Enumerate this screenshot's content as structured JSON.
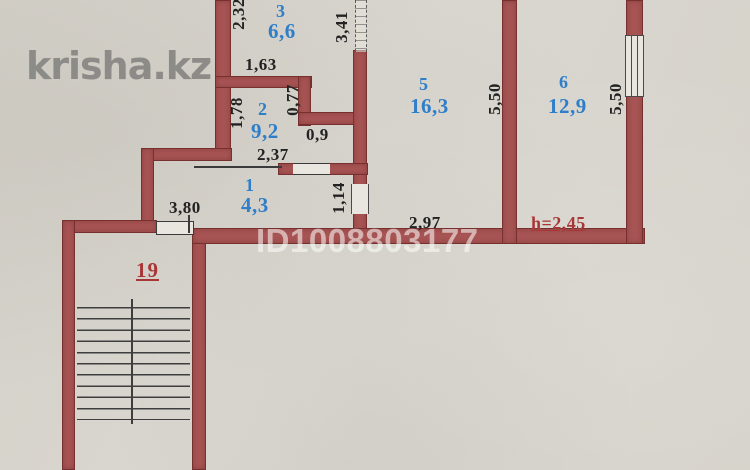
{
  "page": {
    "type": "apartment-floor-plan-scan"
  },
  "watermarks": {
    "site": "krisha.kz",
    "listing_id": "ID1008803177"
  },
  "rooms": [
    {
      "number": "1",
      "area": "4,3"
    },
    {
      "number": "2",
      "area": "9,2"
    },
    {
      "number": "3",
      "area": "6,6"
    },
    {
      "number": "5",
      "area": "16,3"
    },
    {
      "number": "6",
      "area": "12,9"
    },
    {
      "number": "19",
      "area": null
    }
  ],
  "dimensions": [
    {
      "value": "2,32",
      "orientation": "vertical"
    },
    {
      "value": "1,63",
      "orientation": "horizontal"
    },
    {
      "value": "1,78",
      "orientation": "vertical"
    },
    {
      "value": "0,77",
      "orientation": "vertical"
    },
    {
      "value": "0,9",
      "orientation": "horizontal"
    },
    {
      "value": "2,37",
      "orientation": "horizontal"
    },
    {
      "value": "3,80",
      "orientation": "horizontal"
    },
    {
      "value": "1,14",
      "orientation": "vertical"
    },
    {
      "value": "3,41",
      "orientation": "vertical"
    },
    {
      "value": "5,50",
      "orientation": "vertical"
    },
    {
      "value": "5,50",
      "orientation": "vertical"
    },
    {
      "value": "2,97",
      "orientation": "horizontal"
    }
  ],
  "annotations": {
    "ceiling_height": "h=2,45"
  },
  "colors": {
    "background": "#d6d3cb",
    "wall": "#a85454",
    "wall_edge": "#763030",
    "room_label": "#2e7ec9",
    "dimension_text": "#222222",
    "red_text": "#a83636",
    "site_watermark": "#7d7d7a",
    "id_watermark": "#fafaf7"
  }
}
